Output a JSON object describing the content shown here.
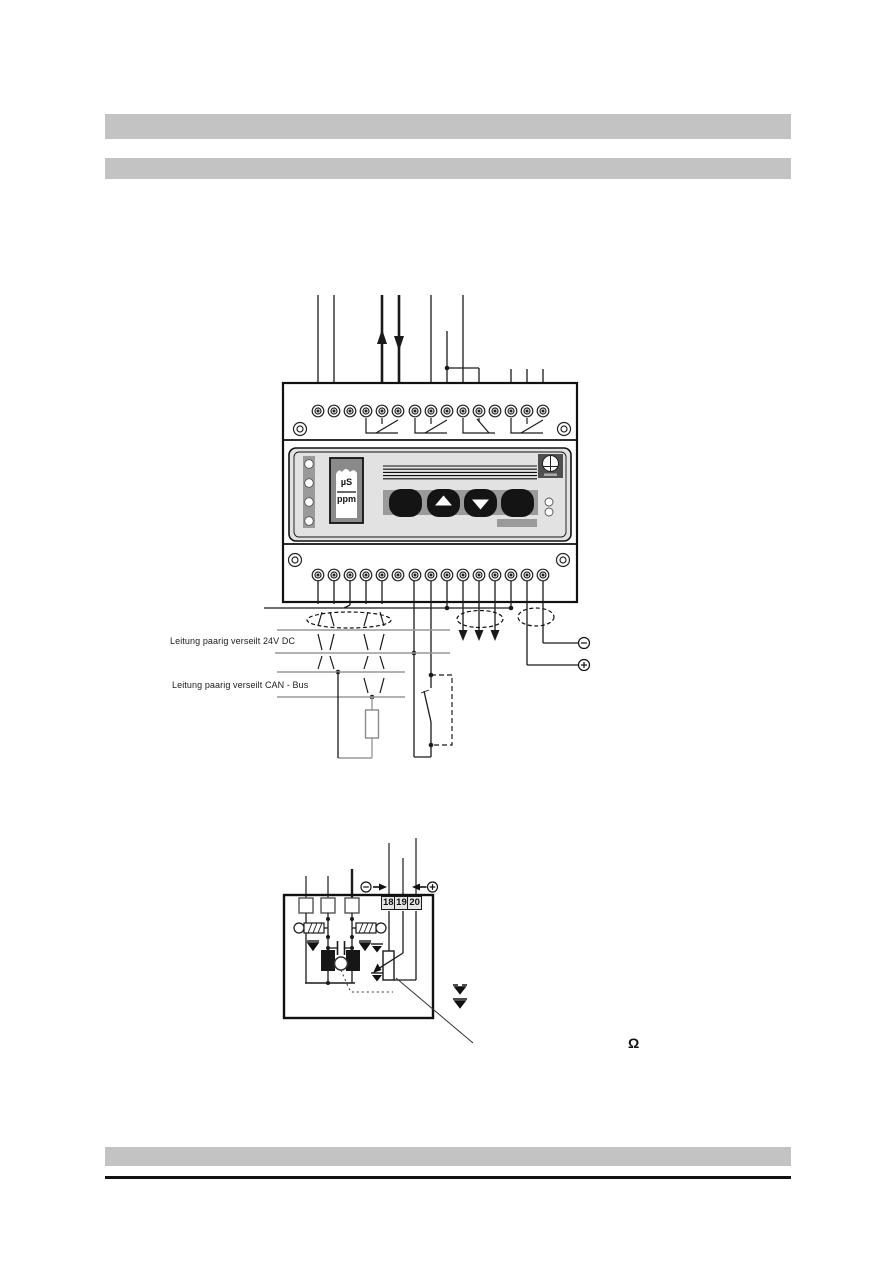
{
  "page": {
    "kind": "installation-manual-page",
    "colors": {
      "bar_gray": "#c3c3c3",
      "panel_gray": "#e2e2e2",
      "mid_gray": "#9a9a9a",
      "line_black": "#1a1a1a",
      "rail_gray": "#999999"
    }
  },
  "wiring_diagram": {
    "cable_labels": {
      "power": "Leitung paarig verseilt 24V DC",
      "can_bus": "Leitung paarig verseilt CAN - Bus"
    },
    "device": {
      "terminals_top_count": 15,
      "terminals_bottom_count": 15,
      "display": {
        "line1": "µS",
        "line2": "ppm"
      },
      "buttons": [
        "round",
        "up-arrow",
        "down-arrow",
        "round"
      ],
      "status_leds_count": 4
    },
    "polarity": {
      "minus": "−",
      "plus": "+"
    }
  },
  "terminal_detail": {
    "terminal_numbers": [
      "18",
      "19",
      "20"
    ],
    "polarity": {
      "minus": "−",
      "plus": "+"
    },
    "unit_symbol": "Ω"
  }
}
